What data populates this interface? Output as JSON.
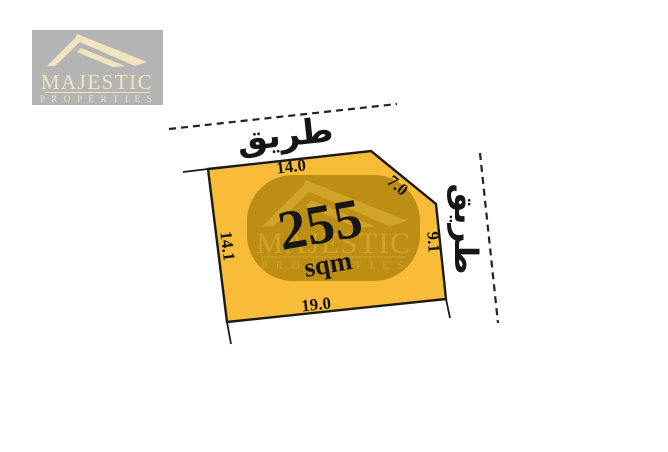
{
  "brand": {
    "name": "MAJESTIC",
    "subtitle": "P R O P E R T I E S"
  },
  "plot": {
    "area_value": "255",
    "area_unit": "sqm",
    "edge_lengths": {
      "top": "14.0",
      "corner_cut": "7.0",
      "right": "9.1",
      "left": "14.1",
      "bottom": "19.0"
    },
    "road_label_top": "طريق",
    "road_label_right": "طريق"
  },
  "colors": {
    "plot_fill": "#F8BC38",
    "plot_border": "#1A1A1A",
    "watermark_bg": "#BD8E14",
    "watermark_logo": "#CFA428",
    "logo_box_bg": "#B4B4B4",
    "logo_cream": "#F2E4BE",
    "label_text": "#161616",
    "road_line": "#222222"
  }
}
